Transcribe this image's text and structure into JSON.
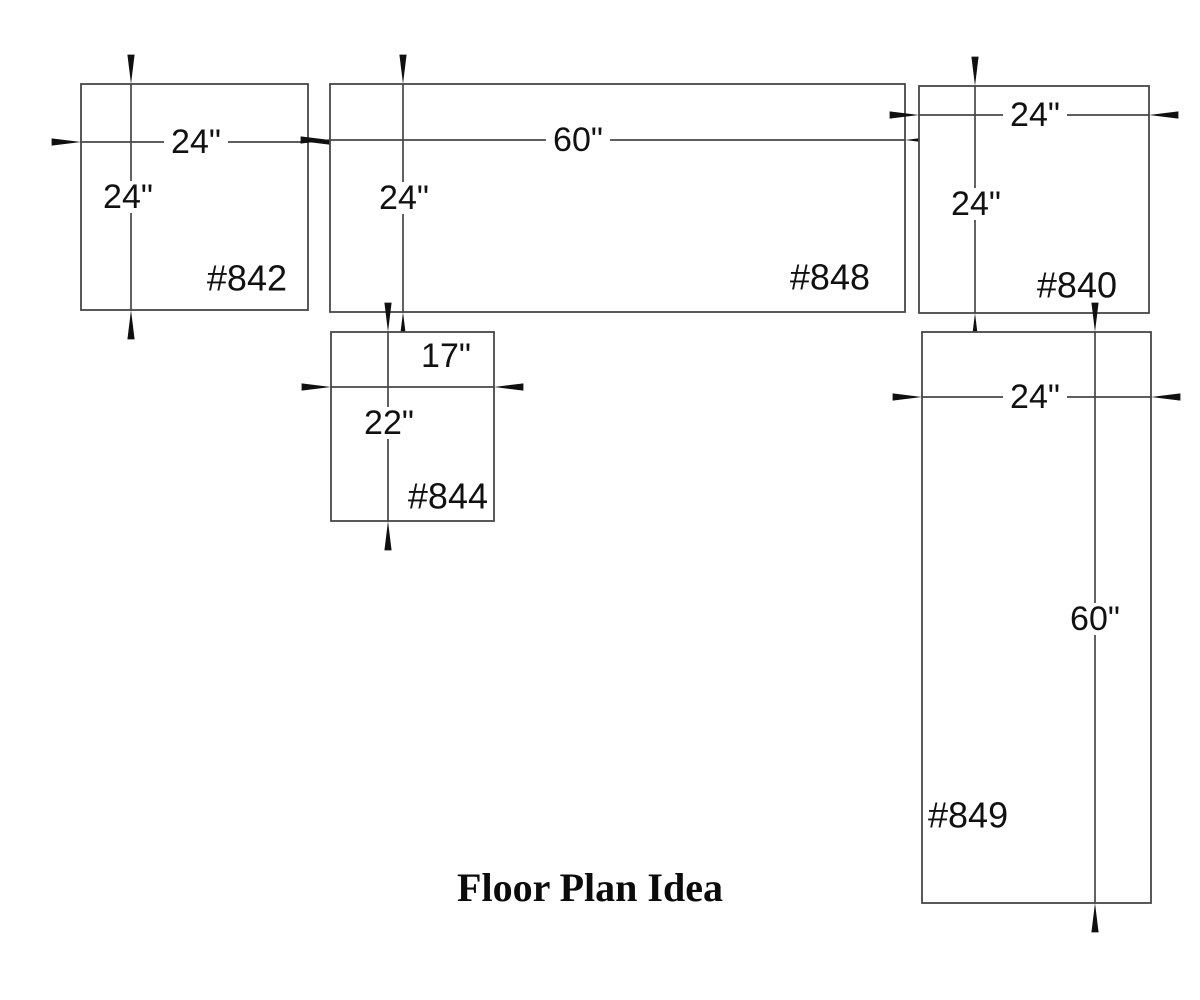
{
  "title": "Floor Plan Idea",
  "units": [
    {
      "id": "#842",
      "width_label": "24\"",
      "height_label": "24\""
    },
    {
      "id": "#848",
      "width_label": "60\"",
      "height_label": "24\""
    },
    {
      "id": "#840",
      "width_label": "24\"",
      "height_label": "24\""
    },
    {
      "id": "#844",
      "width_label": "17\"",
      "height_label": "22\""
    },
    {
      "id": "#849",
      "width_label": "24\"",
      "height_label": "60\""
    }
  ],
  "colors": {
    "background": "#ffffff",
    "line": "#474747",
    "arrow": "#101010",
    "text": "#111111"
  }
}
